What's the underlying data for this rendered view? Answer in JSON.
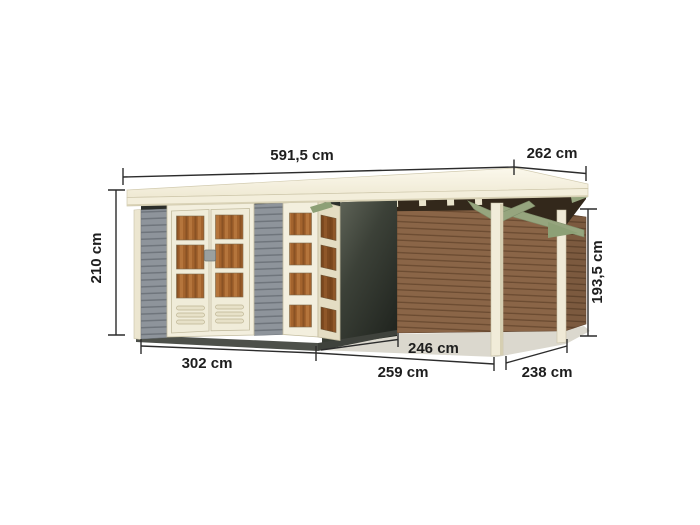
{
  "diagram": {
    "type": "product-dimension-drawing",
    "subject": "garden shed with flat roof and side annex roof",
    "background": "#ffffff",
    "labels": {
      "roof_width": "591,5 cm",
      "roof_depth": "262 cm",
      "wall_height": "210 cm",
      "eave_height": "193,5 cm",
      "shed_width": "302 cm",
      "shed_depth": "246 cm",
      "annex_width": "259 cm",
      "annex_depth": "238 cm"
    },
    "colors": {
      "roof_cream": "#f4efdc",
      "roof_top_highlight": "#fbf8ec",
      "wall_gray": "#8e949b",
      "wall_gray_line": "#6f757c",
      "shadow_wall_dark": "#22261f",
      "soffit_dark": "#33281b",
      "timber_brown": "#8a6547",
      "timber_brown_line": "#6b4b31",
      "frame_cream": "#f3efde",
      "glass_amber": "#a3632d",
      "bracket_sage": "#96a57e",
      "base_dark": "#4d504a",
      "ground_shadow": "#dbd8ce",
      "dimension_ink": "#2c2c2c"
    }
  }
}
